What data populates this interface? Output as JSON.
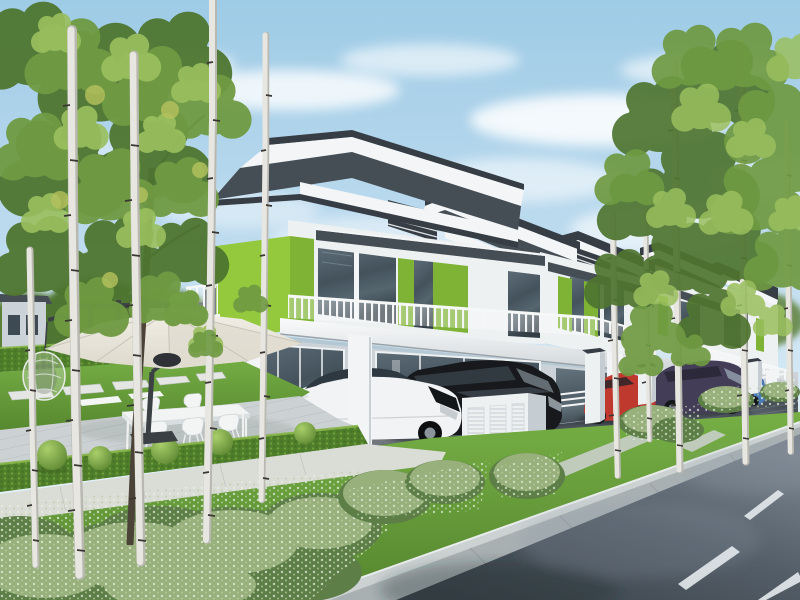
{
  "meta": {
    "title": "Modern double-storey terrace houses - exterior architectural render",
    "type": "photorealistic 3D rendering",
    "visible_text": ""
  },
  "palette": {
    "sky_top": "#9ecbe6",
    "sky_mid": "#bfdcef",
    "sky_low": "#e2eff8",
    "roof_dark": "#454d55",
    "roof_deep": "#363d44",
    "fascia_white": "#f3f5f6",
    "fascia_shade": "#dde2e5",
    "wall_white": "#eef1f2",
    "wall_shade": "#ccd3d8",
    "wall_dark": "#b2bac1",
    "green_lit": "#94c83d",
    "green_mid": "#7fb335",
    "green_dark": "#699b2b",
    "glass_dark": "#3e4a53",
    "slab_white": "#f7f9f9",
    "column_white": "#f2f4f5",
    "deck": "#ccd1d3",
    "deck_line": "#b3b9bc",
    "lawn": "#6ea844",
    "lawn_dark": "#507f2d",
    "hedge": "#4f7f2a",
    "hedge_lit": "#73a53a",
    "shrub_silver": "#9eb682",
    "shrub_light": "#dde8d2",
    "shrub_dark": "#5d7f47",
    "path": "#dadcd6",
    "curb_top": "#ccd2d2",
    "curb_face": "#a8b0b2",
    "road_far": "#7e8893",
    "road_near": "#3a424a",
    "road_mark": "#e2e7ea",
    "drive_dark": "#31373e",
    "car_white": "#f1f3f4",
    "car_black": "#17191c",
    "car_red": "#c0392e",
    "car_purple": "#433d58",
    "car_blue": "#4a7ab5",
    "trunk_birch": "#e7e6e0",
    "trunk_fleck": "#3a3733",
    "trunk_tree": "#4c4338",
    "leaf_light": "#9abf5e",
    "leaf_mid": "#6f9a42",
    "leaf_dark": "#4f7530",
    "leaf_back": "#5d8038",
    "umbrella": "#ece9df",
    "umbrella_shade": "#ddd9cc",
    "metal_dark": "#3b4045"
  },
  "scene": {
    "houses": {
      "style": "modern flat-roof double-storey terrace row",
      "accent": "lime-green feature panels",
      "units_visible": 5
    },
    "cars": [
      {
        "name": "white-sports-sedan"
      },
      {
        "name": "black-mpv"
      },
      {
        "name": "red-hatchback"
      },
      {
        "name": "dark-purple-mpv"
      },
      {
        "name": "blue-sedan"
      }
    ],
    "garden": [
      "cantilever-umbrella",
      "outdoor-dining-set",
      "hanging-egg-chair",
      "topiary-balls",
      "boxwood-hedge",
      "birch-trees",
      "stepping-stones",
      "timber-deck"
    ],
    "street": [
      "asphalt-road",
      "dashed-lane-markings",
      "concrete-curb",
      "grass-verge",
      "shrub-beds",
      "meter-cabinets"
    ]
  }
}
